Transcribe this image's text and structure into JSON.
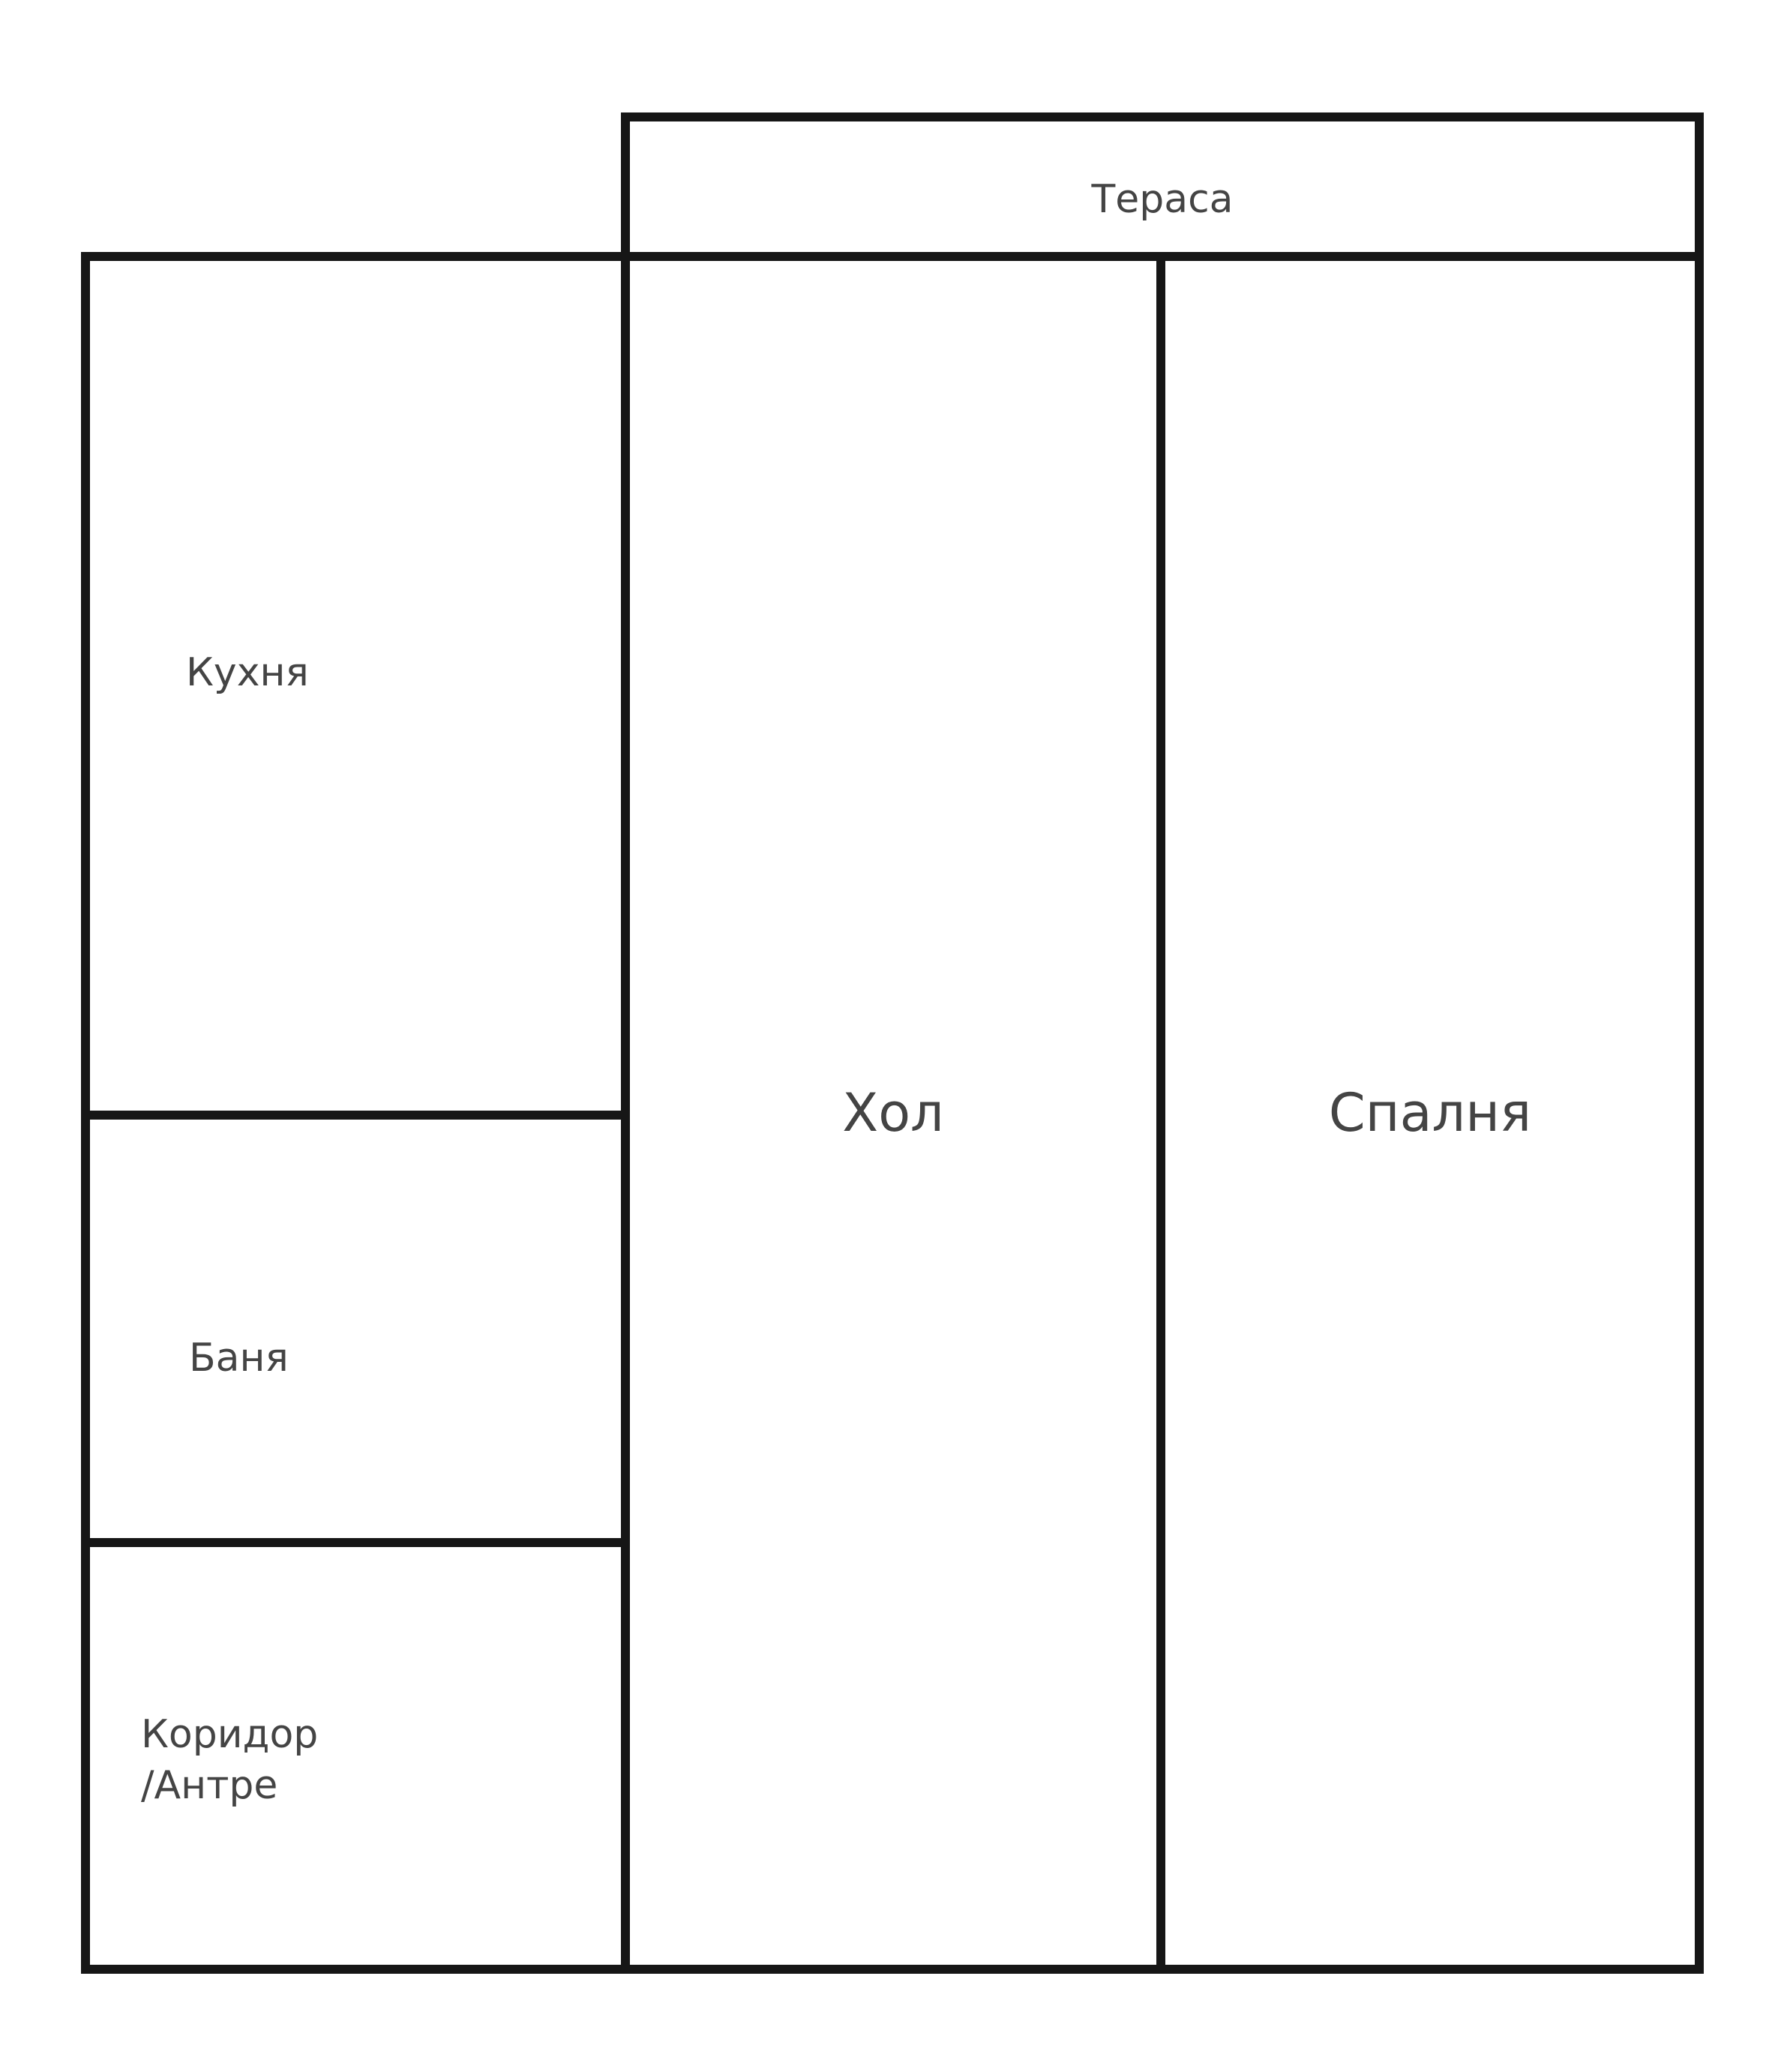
{
  "floorplan": {
    "title": "apartment-floor-plan",
    "rooms": {
      "terrace": {
        "label": "Тераса"
      },
      "kitchen": {
        "label": "Кухня"
      },
      "bath": {
        "label": "Баня"
      },
      "corridor": {
        "label_line1": "Коридор",
        "label_line2": "/Антре"
      },
      "hall": {
        "label": "Хол"
      },
      "bedroom": {
        "label": "Спалня"
      }
    },
    "colors": {
      "wall": "#161616",
      "label": "#444444",
      "background": "#ffffff"
    }
  }
}
